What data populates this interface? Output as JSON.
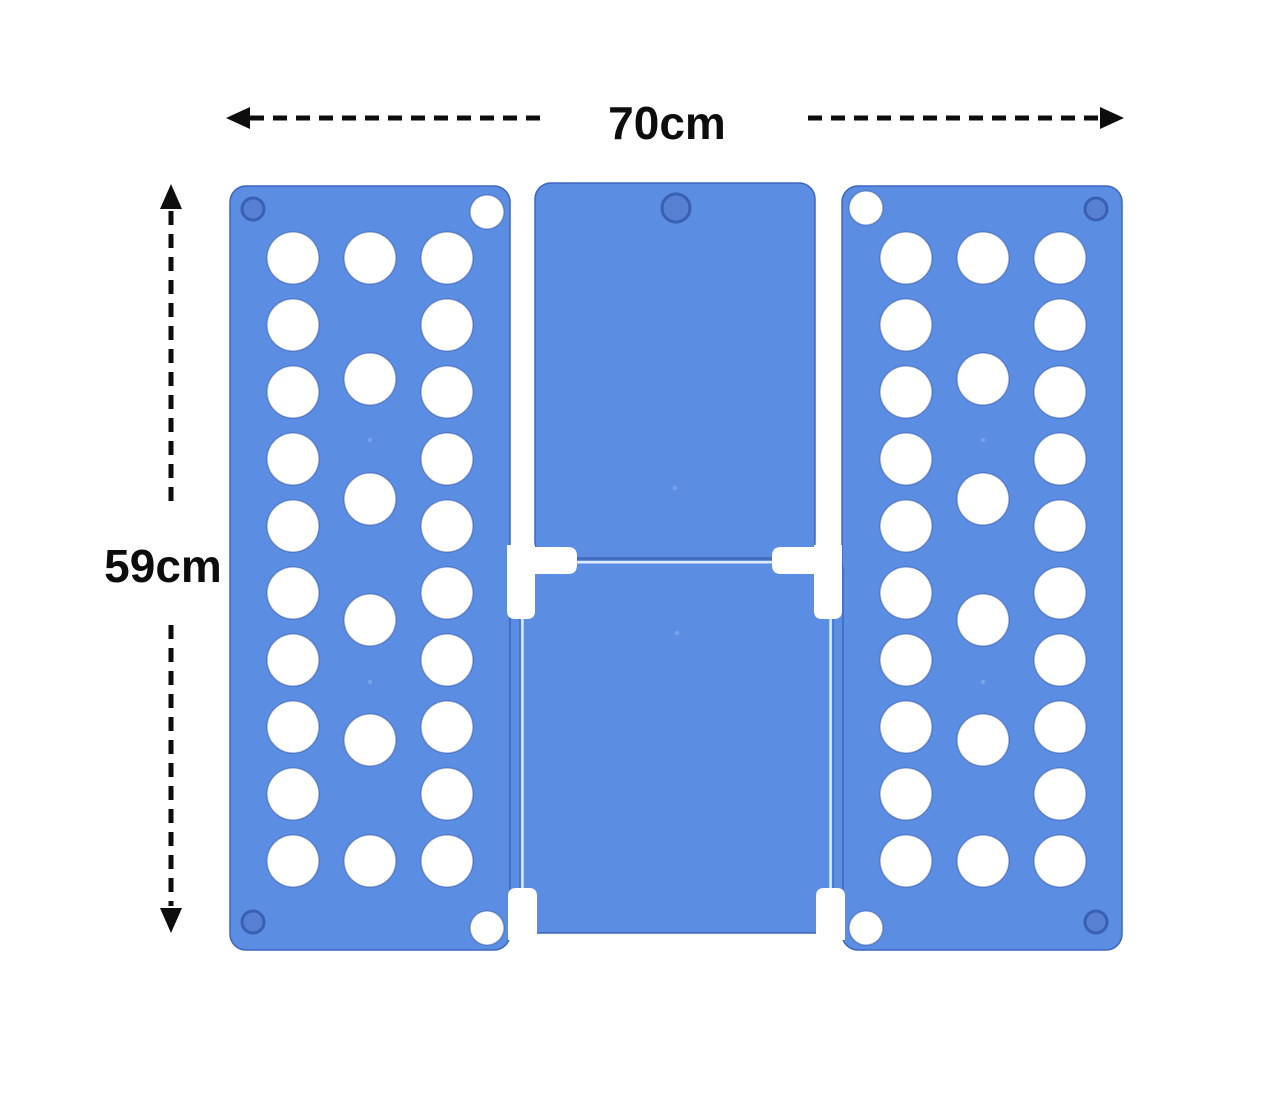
{
  "title": "Clothes folding board with dimension arrows",
  "labels": {
    "width": "70cm",
    "height": "59cm"
  },
  "icons": {
    "width_arrow_left": "dashed-arrow-left-icon",
    "width_arrow_right": "dashed-arrow-right-icon",
    "height_arrow_up": "dashed-arrow-up-icon",
    "height_arrow_down": "dashed-arrow-down-icon"
  },
  "colors": {
    "background": "#ffffff",
    "ink": "#0d0d0d",
    "board_blue": "#5b8de2",
    "panel_outline": "#3c66bb",
    "hole_white": "#ffffff",
    "hole_rim": "rgba(42,72,150,0.38)",
    "recess_fill": "#577fd2",
    "recess_ring": "#3a60b4",
    "groove_light": "#dce9fb",
    "groove_dark": "#466fc2",
    "mold_dot": "#7ea7ea"
  },
  "board": {
    "color_name": "blue",
    "left_panel": {
      "hole_columns": 3,
      "large_holes": 26,
      "corner_holes": 2,
      "corner_recesses": 2
    },
    "right_panel": {
      "hole_columns": 3,
      "large_holes": 26,
      "corner_holes": 2,
      "corner_recesses": 2
    },
    "top_flap": {
      "corner_recesses": 1
    },
    "bottom_panel": {
      "hinge_grooves": 3
    }
  }
}
